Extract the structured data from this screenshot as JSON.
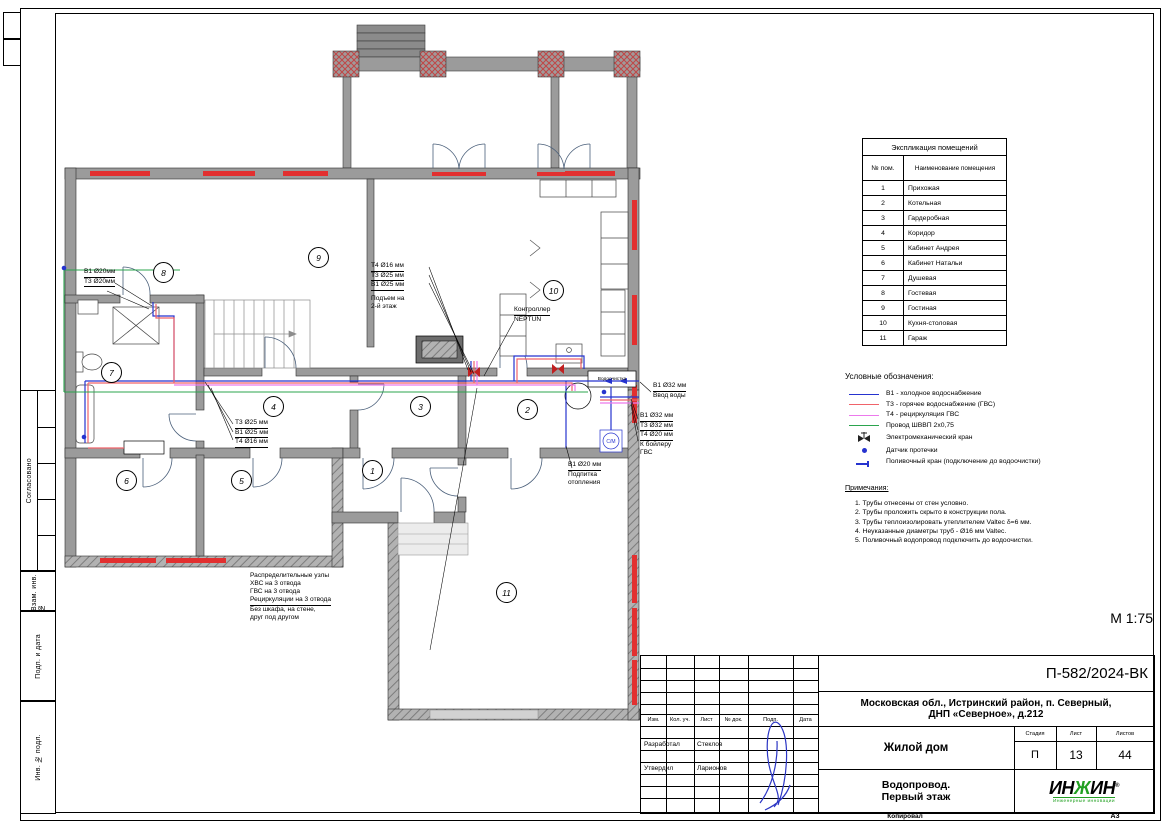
{
  "sheet": {
    "scale_label": "М 1:75",
    "copied_label": "Копировал",
    "format_label": "А3"
  },
  "left_stamp": {
    "sections": [
      "Согласовано",
      "Взам. инв. №",
      "Подп. и дата",
      "Инв. № подл."
    ]
  },
  "room_table": {
    "title": "Экспликация помещений",
    "col_num": "№ пом.",
    "col_name": "Наименование помещения",
    "rows": [
      {
        "num": "1",
        "name": "Прихожая"
      },
      {
        "num": "2",
        "name": "Котельная"
      },
      {
        "num": "3",
        "name": "Гардеробная"
      },
      {
        "num": "4",
        "name": "Коридор"
      },
      {
        "num": "5",
        "name": "Кабинет Андрея"
      },
      {
        "num": "6",
        "name": "Кабинет Натальи"
      },
      {
        "num": "7",
        "name": "Душевая"
      },
      {
        "num": "8",
        "name": "Гостевая"
      },
      {
        "num": "9",
        "name": "Гостиная"
      },
      {
        "num": "10",
        "name": "Кухня-столовая"
      },
      {
        "num": "11",
        "name": "Гараж"
      }
    ]
  },
  "legend": {
    "title": "Условные обозначения:",
    "items": [
      {
        "label": "В1 - холодное водоснабжение",
        "color": "#2633cf",
        "symbol": "line"
      },
      {
        "label": "Т3 - горячее водоснабжение (ГВС)",
        "color": "#f0636a",
        "symbol": "line"
      },
      {
        "label": "Т4 - рециркуляция ГВС",
        "color": "#ec79ec",
        "symbol": "line"
      },
      {
        "label": "Провод ШВВП 2х0,75",
        "color": "#2ba44e",
        "symbol": "line"
      },
      {
        "label": "Электромеханический кран",
        "color": "#b03030",
        "symbol": "valve"
      },
      {
        "label": "Датчик протечки",
        "color": "#2633cf",
        "symbol": "dot"
      },
      {
        "label": "Поливочный кран (подключение до водоочистки)",
        "color": "#2633cf",
        "symbol": "tap"
      }
    ]
  },
  "notes": {
    "title": "Примечания:",
    "items": [
      "1.    Трубы отнесены от стен условно.",
      "2.    Трубы проложить скрыто в конструкции пола.",
      "3.    Трубы теплоизолировать утеплителем Valtec δ=6 мм.",
      "4.    Неуказанные диаметры труб - Ø16 мм Valtec.",
      "5.    Поливочный водопровод подключить до водоочистки."
    ]
  },
  "plan": {
    "rooms": [
      {
        "num": "1"
      },
      {
        "num": "2"
      },
      {
        "num": "3"
      },
      {
        "num": "4"
      },
      {
        "num": "5"
      },
      {
        "num": "6"
      },
      {
        "num": "7"
      },
      {
        "num": "8"
      },
      {
        "num": "9"
      },
      {
        "num": "10"
      },
      {
        "num": "11"
      }
    ],
    "labels": {
      "water_treatment": "Водоочистка",
      "washing_machine": "С/М"
    },
    "annotations": {
      "left_pipes": {
        "lines": [
          "В1 Ø20мм",
          "Т3 Ø20мм"
        ]
      },
      "corridor_pipes": {
        "lines": [
          "Т3 Ø25 мм",
          "В1 Ø25 мм",
          "Т4 Ø16 мм"
        ]
      },
      "riser": {
        "lines": [
          "Т4 Ø16 мм",
          "Т3 Ø25 мм",
          "В1 Ø25 мм"
        ],
        "note": [
          "Подъем на",
          "2-й этаж"
        ]
      },
      "controller": {
        "lines": [
          "Контроллер",
          "NEPTUN"
        ]
      },
      "inlet": {
        "lines": [
          "В1 Ø32 мм",
          "Ввод воды"
        ]
      },
      "boiler_feed": {
        "lines": [
          "В1 Ø32 мм",
          "Т3 Ø32 мм",
          "Т4 Ø20 мм",
          "К бойлеру",
          "ГВС"
        ]
      },
      "heating_feed": {
        "lines": [
          "В1 Ø20 мм",
          "Подпитка",
          "отопления"
        ]
      },
      "manifold": {
        "lines": [
          "Распределительные узлы",
          "ХВС на 3 отвода",
          "ГВС на 3 отвода",
          "Рециркуляции на 3 отвода",
          "Без шкафа, на стене,",
          "друг под другом"
        ]
      }
    }
  },
  "title_block": {
    "doc_number": "П-582/2024-ВК",
    "address1": "Московская обл., Истринский район, п. Северный,",
    "address2": "ДНП «Северное», д.212",
    "object_name": "Жилой дом",
    "title1": "Водопровод.",
    "title2": "Первый этаж",
    "stage_label": "Стадия",
    "sheet_label": "Лист",
    "sheets_label": "Листов",
    "stage": "П",
    "sheet_num": "13",
    "sheets_total": "44",
    "header_cols": [
      "Изм.",
      "Кол. уч.",
      "Лист",
      "№ док.",
      "Подп.",
      "Дата"
    ],
    "roles": [
      {
        "role": "Разработал",
        "name": "Стеклов"
      },
      {
        "role": "Утвердил",
        "name": "Ларионов"
      }
    ],
    "logo": {
      "part1": "ИН",
      "part2": "Ж",
      "part3": "ИН",
      "reg": "®",
      "tagline": "Инженерные инновации",
      "color": "#22a022"
    }
  }
}
